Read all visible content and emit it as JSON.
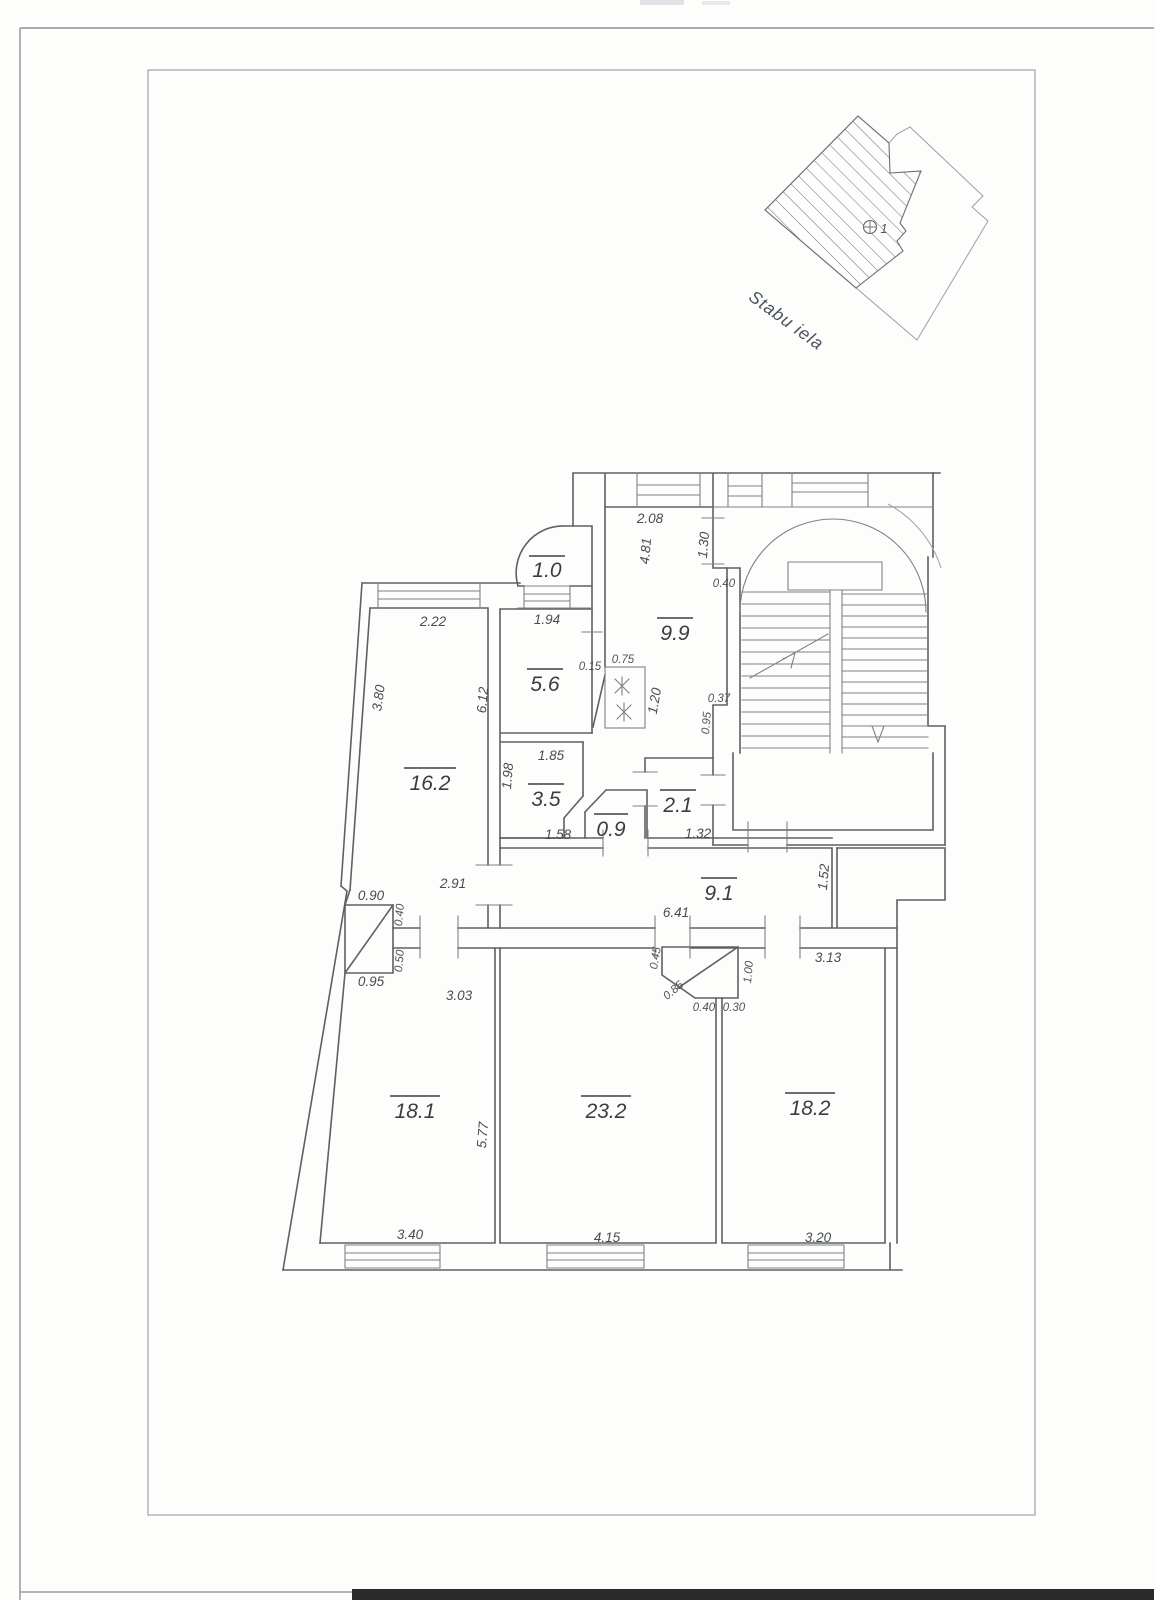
{
  "site_plan": {
    "street_label": "Stabu iela",
    "building_marker": "1"
  },
  "rooms": {
    "balcony": "1.0",
    "room_9_9": "9.9",
    "kitchen": "5.6",
    "room_16_2": "16.2",
    "room_3_5": "3.5",
    "wc": "0.9",
    "hall_2_1": "2.1",
    "corridor": "9.1",
    "room_18_1": "18.1",
    "room_23_2": "23.2",
    "room_18_2": "18.2"
  },
  "dimensions": {
    "room16_top": "2.22",
    "kitchen_top": "1.94",
    "room99_top": "2.08",
    "room99_left": "4.81",
    "room99_right": "1.30",
    "room99_notch": "0.40",
    "room16_slant": "3.80",
    "room16_height": "6.12",
    "stove_left": "0.15",
    "stove_top": "0.75",
    "stove_right": "1.20",
    "stair_wall_top": "0.37",
    "stair_wall_side": "0.95",
    "room35_top": "1.85",
    "room35_left": "1.98",
    "room35_bottom": "1.58",
    "hall21_bottom": "1.32",
    "passage_width": "2.91",
    "corridor_length": "6.41",
    "corridor_right": "1.52",
    "shaft1_top": "0.90",
    "shaft1_side_a": "0.40",
    "shaft1_side_b": "0.50",
    "shaft1_bottom": "0.95",
    "room181_top": "3.03",
    "room181_side": "5.77",
    "room181_bottom": "3.40",
    "shaft2_left": "0.45",
    "shaft2_diag": "0.85",
    "shaft2_right": "1.00",
    "shaft2_bottom_a": "0.40",
    "shaft2_bottom_b": "0.30",
    "room182_top": "3.13",
    "room182_bottom": "3.20",
    "room232_bottom": "4.15"
  },
  "colors": {
    "wall_line": "#5c6165",
    "thin_line": "#7d8287",
    "text": "#474c51",
    "paper": "#fdfdfc",
    "bottom_band": "#2b2b2b"
  }
}
